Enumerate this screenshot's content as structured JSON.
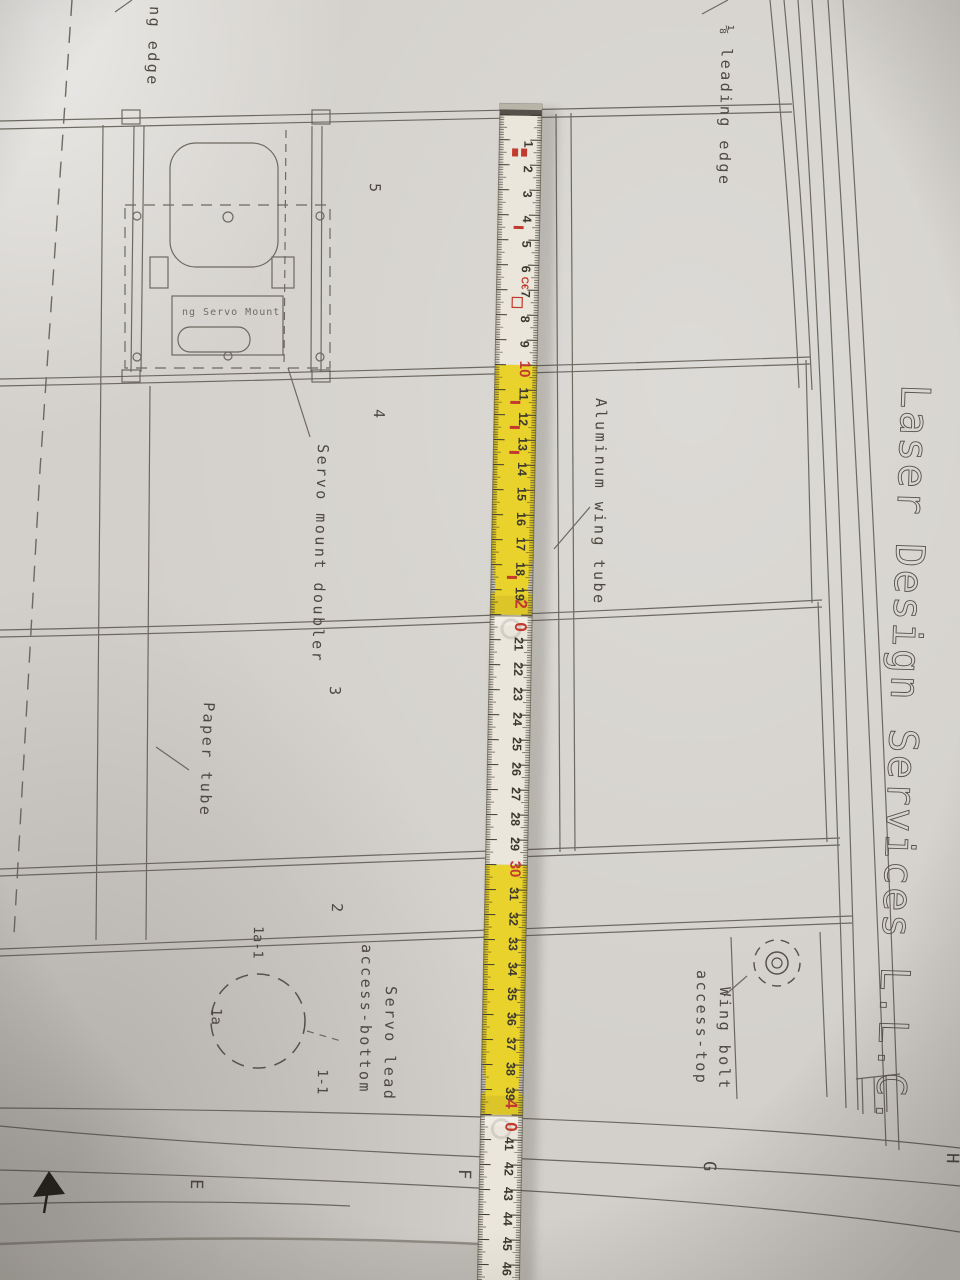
{
  "sheet": {
    "title": "Laser Design Services L.L.C.",
    "zone_letters": {
      "e": "E",
      "f": "F",
      "g": "G",
      "h": "H"
    },
    "labels": {
      "leading_edge": "⅛ leading edge",
      "edge_partial": "ng edge",
      "servo_mount_doubler": "Servo mount doubler",
      "paper_tube": "Paper tube",
      "aluminum_wing_tube": "Aluminum wing tube",
      "servo_lead_1": "Servo lead",
      "servo_lead_2": "access-bottom",
      "wing_bolt_1": "Wing bolt",
      "wing_bolt_2": "access-top",
      "servo_mount_plate": "ng Servo Mount"
    },
    "part_numbers": {
      "n5": "5",
      "n4": "4",
      "n3": "3",
      "n2": "2",
      "n1a_1": "1a-1",
      "n1a": "1a",
      "n1_1": "1-1"
    }
  },
  "ruler": {
    "start_cm": 1,
    "end_cm": 46,
    "red_numbers": [
      10,
      20,
      30,
      40
    ],
    "ce_mark": "C€",
    "colors": {
      "yellow": "#e9d22b",
      "white": "#eae6db",
      "red": "#c23a2e",
      "ink": "#3b382f"
    }
  }
}
